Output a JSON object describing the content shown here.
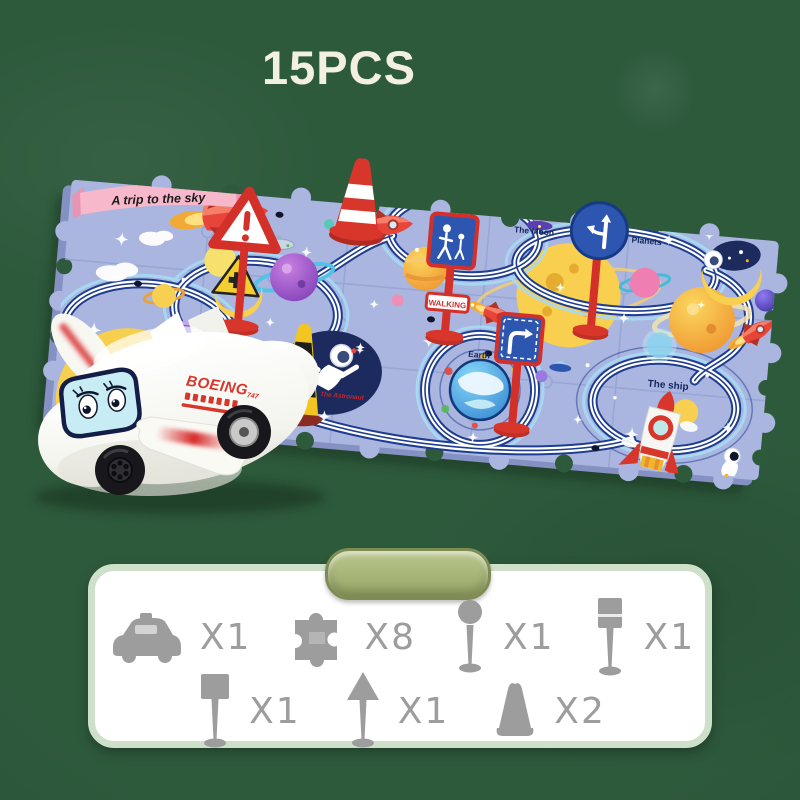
{
  "header": {
    "pieces_label": "15PCS"
  },
  "mat": {
    "banner_label": "A trip to the sky",
    "area_labels": {
      "moon": "The Moon",
      "planets": "Planets",
      "astronaut": "The Astronaut",
      "earth": "Earth",
      "ship": "The ship"
    },
    "signs": {
      "walking_label": "WALKING"
    }
  },
  "plane": {
    "brand_label": "BOEING",
    "model_label": "747"
  },
  "parts_panel": {
    "rows": [
      [
        {
          "icon": "toy-car",
          "count": "X1"
        },
        {
          "icon": "puzzle-piece",
          "count": "X8"
        },
        {
          "icon": "round-sign",
          "count": "X1"
        },
        {
          "icon": "barrier-sign",
          "count": "X1"
        }
      ],
      [
        {
          "icon": "square-sign",
          "count": "X1"
        },
        {
          "icon": "arrow-sign",
          "count": "X1"
        },
        {
          "icon": "traffic-cone",
          "count": "X2"
        }
      ]
    ]
  },
  "colors": {
    "background_green": "#2e5a3c",
    "mat_blue": "#aab6e0",
    "track_navy": "#1f3d8f",
    "track_light_blue": "#9fd2f0",
    "sign_red": "#d4302a",
    "sign_blue": "#2c56b0",
    "panel_pill_green": "#97a665",
    "silhouette_gray": "#9d9d9d"
  }
}
